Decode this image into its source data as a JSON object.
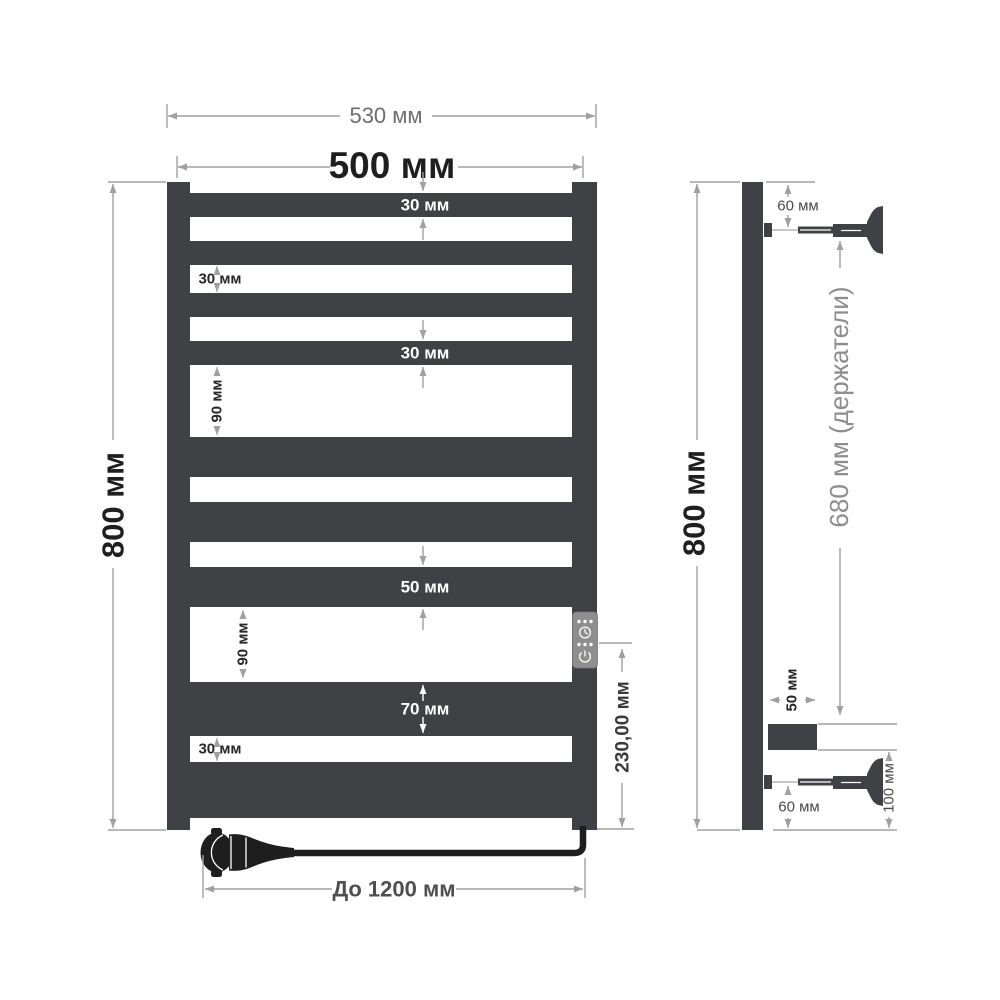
{
  "front_view": {
    "outer_width": "530 мм",
    "bar_width": "500 мм",
    "height": "800 мм",
    "bar1_height": "30 мм",
    "gap_top": "30 мм",
    "bar4_height": "30 мм",
    "gap_mid1": "90 мм",
    "bar7_height": "50 мм",
    "gap_mid2": "90 мм",
    "bar8_height": "70 мм",
    "gap_bottom": "30 мм",
    "controller_height": "230,00 мм",
    "cable_length": "До 1200 мм"
  },
  "side_view": {
    "height": "800 мм",
    "brackets_span": "680 мм (держатели)",
    "top_bracket_offset": "60 мм",
    "controller_depth": "50 мм",
    "controller_to_bottom": "100 мм",
    "bottom_bracket_offset": "60 мм"
  },
  "icons": {
    "controller": [
      "dots-icon",
      "timer-clock-icon",
      "dots-icon",
      "power-icon"
    ]
  },
  "colors": {
    "rail": "#3f4144",
    "dimension_line": "#a0a0a0",
    "text_dark": "#1f1f1f",
    "text_gray": "#6e6e6e",
    "cable": "#1e1e1e",
    "controller_panel": "#8e8e8e"
  }
}
